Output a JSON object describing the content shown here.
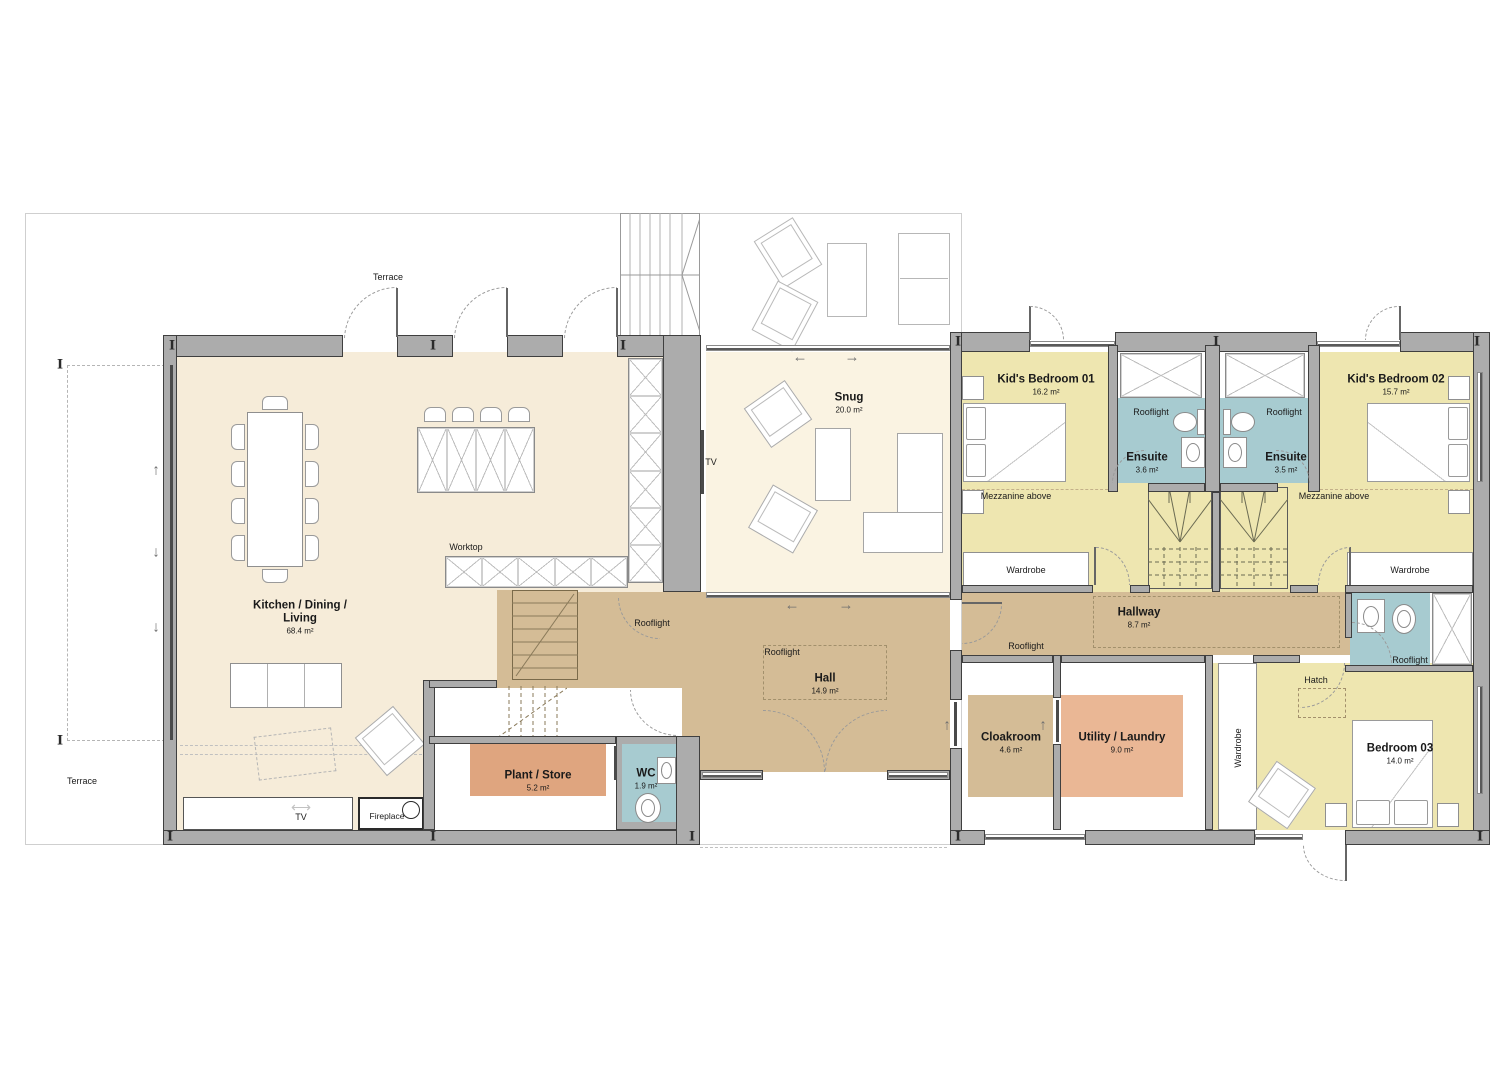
{
  "labels": {
    "terrace": "Terrace",
    "rooflight": "Rooflight",
    "wardrobe": "Wardrobe",
    "mezzanine_above": "Mezzanine above",
    "worktop": "Worktop",
    "tv": "TV",
    "fireplace": "Fireplace",
    "hatch": "Hatch"
  },
  "rooms": {
    "kitchen_dining_living": {
      "name": "Kitchen / Dining / Living",
      "area": "68.4 m²"
    },
    "snug": {
      "name": "Snug",
      "area": "20.0 m²"
    },
    "hall": {
      "name": "Hall",
      "area": "14.9 m²"
    },
    "hallway": {
      "name": "Hallway",
      "area": "8.7 m²"
    },
    "kids_bedroom_01": {
      "name": "Kid's Bedroom 01",
      "area": "16.2 m²"
    },
    "kids_bedroom_02": {
      "name": "Kid's Bedroom 02",
      "area": "15.7 m²"
    },
    "ensuite_01": {
      "name": "Ensuite",
      "area": "3.6 m²"
    },
    "ensuite_02": {
      "name": "Ensuite",
      "area": "3.5 m²"
    },
    "bedroom_03": {
      "name": "Bedroom 03",
      "area": "14.0 m²"
    },
    "cloakroom": {
      "name": "Cloakroom",
      "area": "4.6 m²"
    },
    "utility_laundry": {
      "name": "Utility / Laundry",
      "area": "9.0 m²"
    },
    "plant_store": {
      "name": "Plant / Store",
      "area": "5.2 m²"
    },
    "wc": {
      "name": "WC",
      "area": "1.9 m²"
    }
  },
  "colors": {
    "wall": "#acacac",
    "living": "#f6ecd9",
    "snugc": "#faf3e2",
    "circulation": "#d4bc96",
    "bedroom": "#eee6b0",
    "bathroom": "#a7cbd0",
    "utilityc": "#eab795",
    "plantc": "#dfa57f"
  }
}
